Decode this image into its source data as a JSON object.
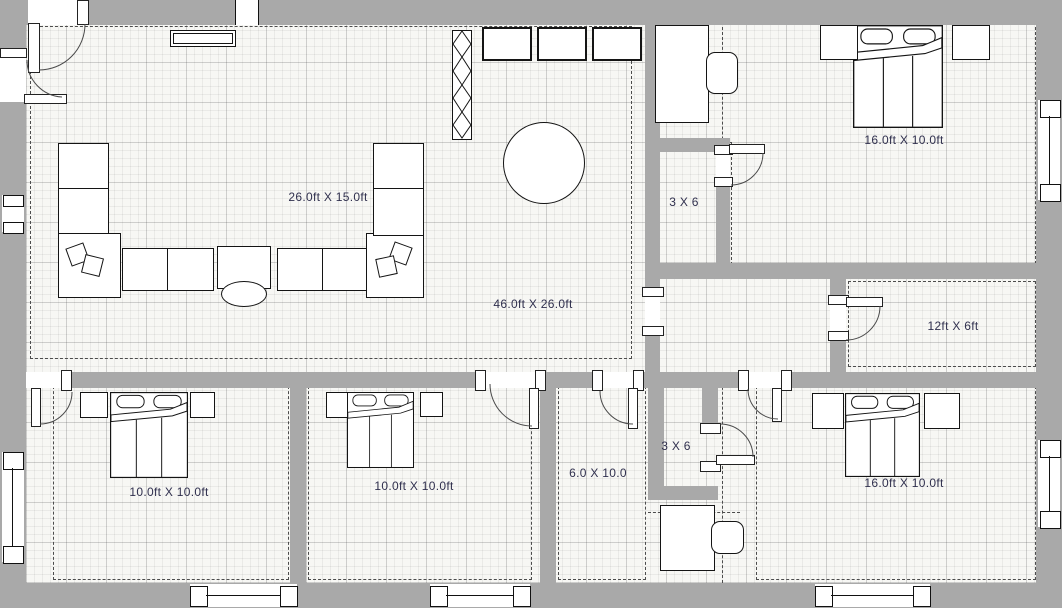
{
  "title": "Residential floor plan",
  "colors": {
    "wall": "#a9a9a9",
    "floor": "#f7f7f4",
    "line": "#141414",
    "label": "#30304e"
  },
  "rooms": {
    "labels": [
      {
        "id": "living-room",
        "text": "46.0ft X 26.0ft"
      },
      {
        "id": "sofa-area",
        "text": "26.0ft X 15.0ft"
      },
      {
        "id": "bedroom-top-right",
        "text": "16.0ft X 10.0ft"
      },
      {
        "id": "bath-top",
        "text": "3 X 6"
      },
      {
        "id": "room-right",
        "text": "12ft X 6ft"
      },
      {
        "id": "bedroom-bottom-left",
        "text": "10.0ft X 10.0ft"
      },
      {
        "id": "bedroom-bottom-middle",
        "text": "10.0ft X 10.0ft"
      },
      {
        "id": "room-middle",
        "text": "6.0 X 10.0"
      },
      {
        "id": "bath-bottom",
        "text": "3 X 6"
      },
      {
        "id": "bedroom-bottom-right",
        "text": "16.0ft X 10.0ft"
      }
    ]
  }
}
